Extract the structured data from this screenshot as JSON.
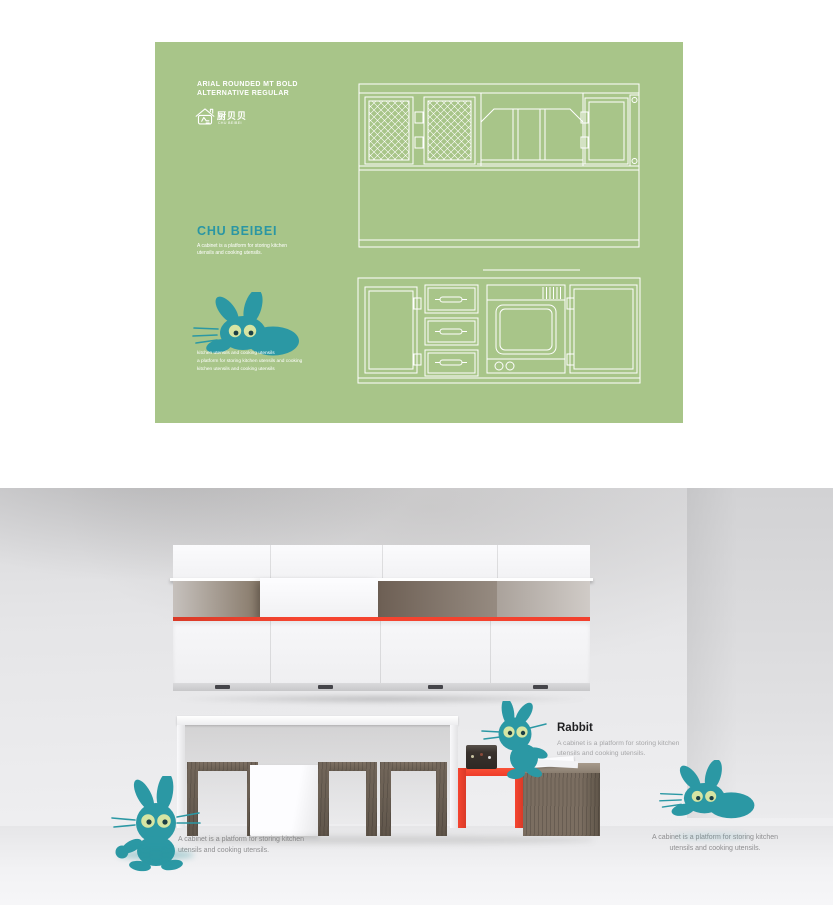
{
  "poster": {
    "spec": {
      "line1": "ARIAL ROUNDED MT BOLD",
      "line2": "ALTERNATIVE REGULAR"
    },
    "logo": {
      "chinese": "厨贝贝",
      "latin": "CHU BEIBEI"
    },
    "title": "CHU BEIBEI",
    "description": {
      "line1": "A cabinet is a platform for storing kitchen",
      "line2": "utensils and cooking utensils."
    },
    "caption": {
      "line1": "kitchen utensils and cooking utensils",
      "line2": "a platform for storing kitchen utensils and cooking",
      "line3": "kitchen utensils and cooking utensils"
    },
    "colors": {
      "background": "#a8c589",
      "teal": "#2b98a4",
      "drawing_lines": "#ffffff"
    }
  },
  "render": {
    "rabbit_label": "Rabbit",
    "rabbit_description": {
      "line1": "A cabinet is a platform for storing kitchen",
      "line2": "utensils and cooking utensils."
    },
    "caption_left": {
      "line1": "A cabinet is a platform for storing kitchen",
      "line2": "utensils and cooking utensils."
    },
    "caption_right": {
      "line1": "A cabinet is a platform for storing kitchen",
      "line2": "utensils and cooking utensils."
    },
    "colors": {
      "accent_red": "#f2402d",
      "mascot_teal": "#2b98a4",
      "eye_green": "#d6e5a3",
      "wood": "#6f6459"
    }
  },
  "icons": {
    "house_logo": "house-logo-icon",
    "rabbit_mascot": "rabbit-mascot-icon",
    "drawings": "cabinet-elevation-drawings"
  }
}
